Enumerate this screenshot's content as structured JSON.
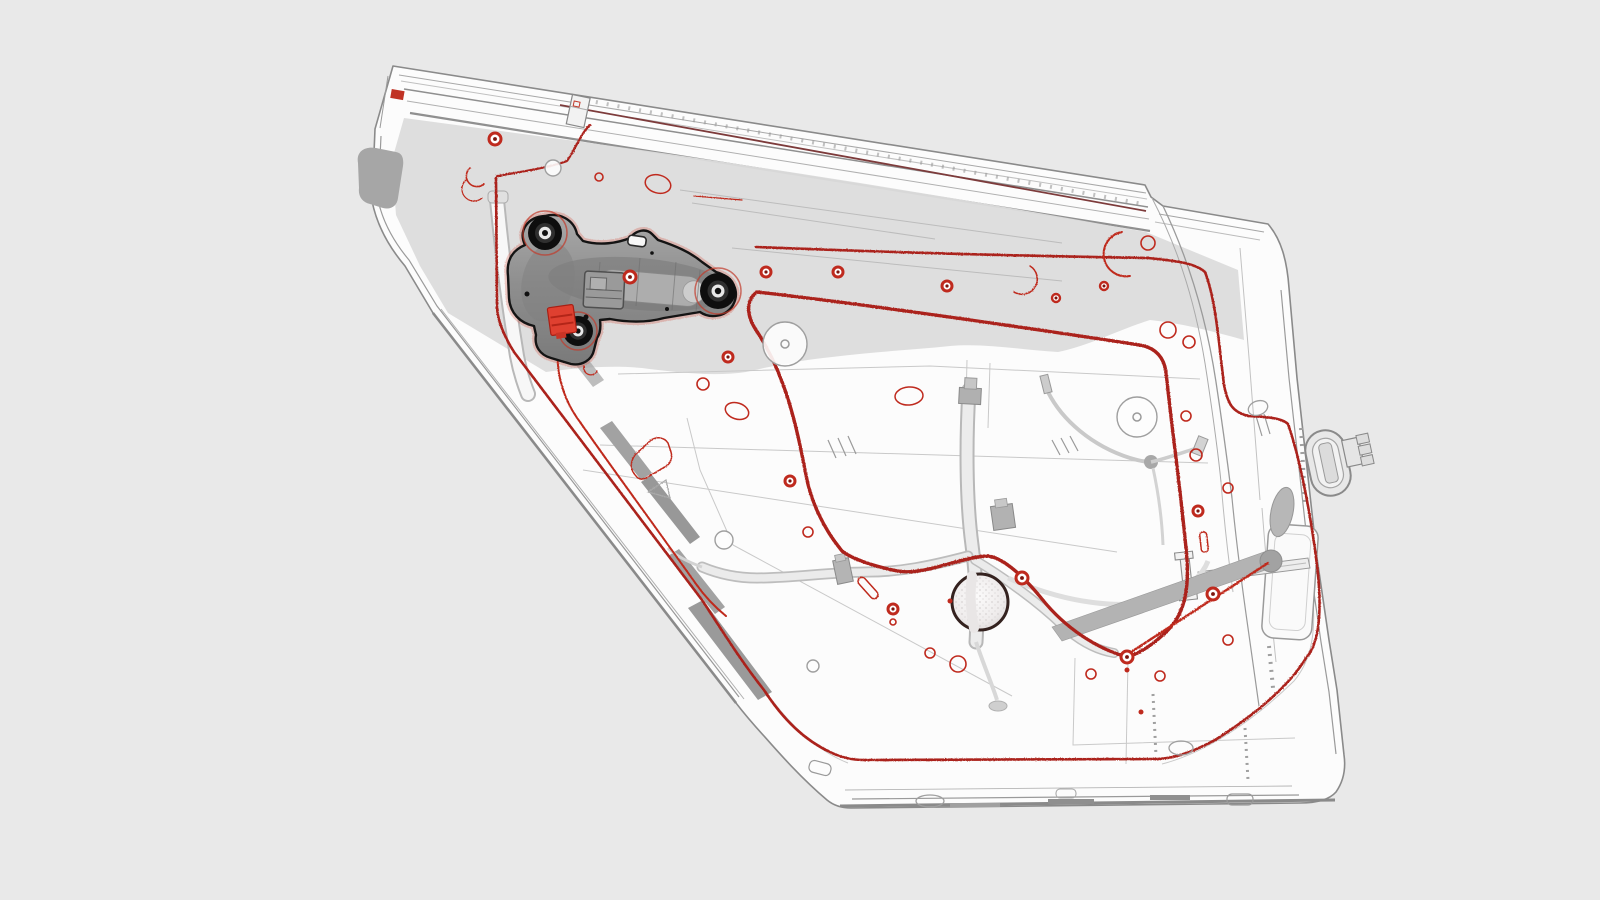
{
  "scene": {
    "kind": "car-door-parts-illustration",
    "view": "rear-door-inner-panel",
    "highlighted_part": "regulator-motor-bracket",
    "has_text": false
  },
  "colors": {
    "background": "#e9e9e9",
    "panel_white": "#fcfcfc",
    "glass_gray": "#dcdcdc",
    "line_gray": "#8a8a8a",
    "line_light": "#b5b5b5",
    "strip_gray": "#a2a2a2",
    "seal_red": "#ab231b",
    "marker_red": "#bf2a1e",
    "maroon_rail": "#7d3b3b",
    "part_dark": "#5f5f5f",
    "part_mid": "#8f8f8f",
    "part_light": "#c2c2c2",
    "grommet_black": "#161616",
    "connector_red": "#df4030",
    "harness_gray": "#d9d9d9",
    "harness_edge": "#b8b8b8",
    "bar_gray": "#b3b3b3"
  },
  "markers": {
    "red_rings": [
      [
        495,
        139,
        6
      ],
      [
        766,
        272,
        5
      ],
      [
        838,
        272,
        5
      ],
      [
        947,
        286,
        5
      ],
      [
        1056,
        298,
        4
      ],
      [
        1104,
        286,
        4
      ],
      [
        728,
        357,
        5
      ],
      [
        790,
        481,
        5
      ],
      [
        1022,
        578,
        6
      ],
      [
        893,
        609,
        5
      ],
      [
        1127,
        657,
        6
      ],
      [
        1213,
        594,
        6
      ],
      [
        1198,
        511,
        5
      ],
      [
        630,
        277,
        6
      ]
    ],
    "red_hollow": [
      [
        599,
        177,
        4
      ],
      [
        1148,
        243,
        7
      ],
      [
        1168,
        330,
        8
      ],
      [
        1189,
        342,
        6
      ],
      [
        1196,
        455,
        6
      ],
      [
        1228,
        488,
        5
      ],
      [
        703,
        384,
        6
      ],
      [
        808,
        532,
        5
      ],
      [
        893,
        622,
        3
      ],
      [
        930,
        653,
        5
      ],
      [
        958,
        664,
        8
      ],
      [
        1091,
        674,
        5
      ],
      [
        1160,
        676,
        5
      ],
      [
        1228,
        640,
        5
      ],
      [
        1186,
        416,
        5
      ]
    ],
    "red_dots": [
      [
        950,
        601,
        2.5
      ],
      [
        1127,
        670,
        2.5
      ],
      [
        1141,
        712,
        2.5
      ]
    ],
    "red_ovals": [
      [
        658,
        184,
        13,
        9,
        15
      ],
      [
        737,
        411,
        12,
        8,
        18
      ],
      [
        909,
        396,
        14,
        9,
        -4
      ]
    ],
    "gray_circles": [
      [
        785,
        344,
        22
      ],
      [
        1137,
        417,
        20
      ],
      [
        813,
        666,
        6
      ],
      [
        724,
        540,
        9
      ],
      [
        553,
        168,
        8
      ]
    ],
    "gray_center_dots": [
      [
        785,
        344,
        4
      ],
      [
        1137,
        417,
        4
      ]
    ],
    "gray_ovals": [
      [
        930,
        801,
        14,
        6,
        0
      ],
      [
        1181,
        748,
        12,
        7,
        0
      ],
      [
        1258,
        408,
        10,
        7,
        -20
      ]
    ]
  }
}
